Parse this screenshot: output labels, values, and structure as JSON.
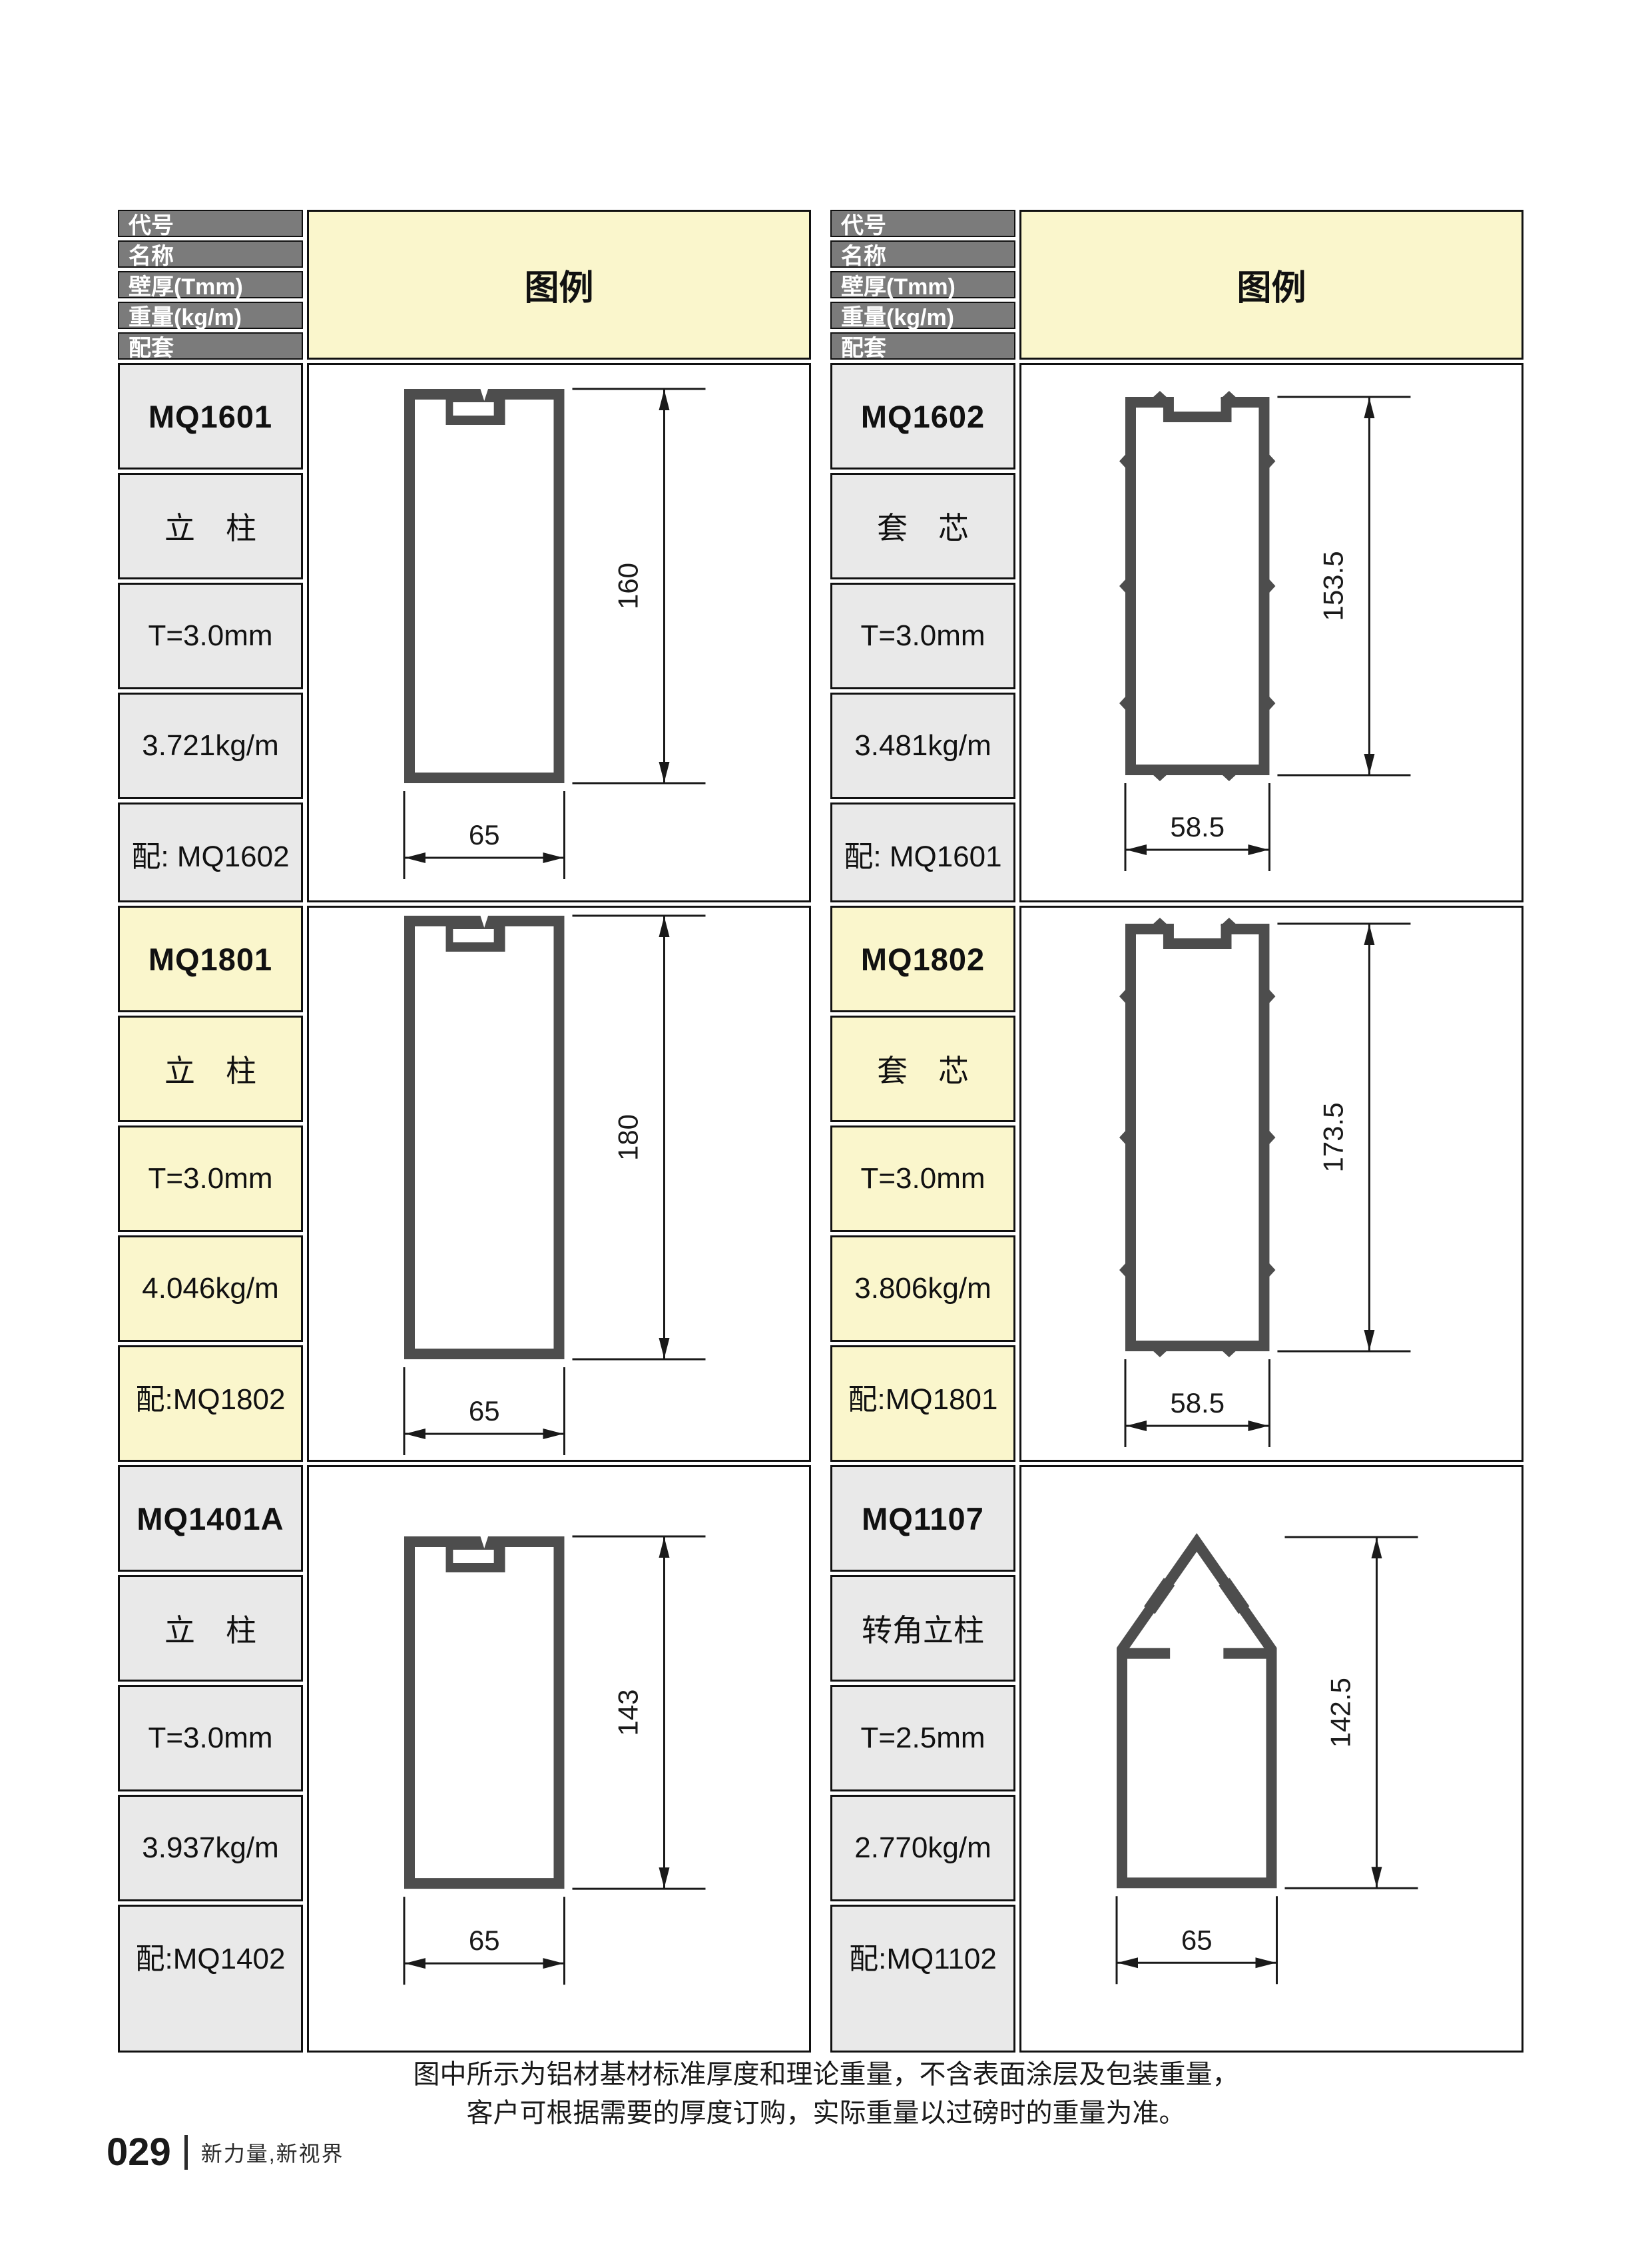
{
  "header_labels": [
    "代号",
    "名称",
    "壁厚(Tmm)",
    "重量(kg/m)",
    "配套"
  ],
  "legend_title": "图例",
  "note": {
    "line1": "图中所示为铝材基材标准厚度和理论重量，不含表面涂层及包装重量，",
    "line2": "客户可根据需要的厚度订购，实际重量以过磅时的重量为准。"
  },
  "footer": {
    "page_number": "029",
    "tagline": "新力量,新视界"
  },
  "colors": {
    "header_cell": "#7b7b7b",
    "cell_light": "#e9e9e9",
    "highlight": "#faf6cc",
    "border": "#111111",
    "profile_stroke": "#4d4d4d",
    "dimension": "#1a1a1a"
  },
  "tables": [
    {
      "side": "left",
      "profiles": [
        {
          "code": "MQ1601",
          "name": "立　柱",
          "thickness": "T=3.0mm",
          "weight": "3.721kg/m",
          "match": "配: MQ1602",
          "highlight": false,
          "drawing": {
            "type": "column",
            "height_mm": 160,
            "width_mm": 65,
            "height_label": "160",
            "width_label": "65"
          }
        },
        {
          "code": "MQ1801",
          "name": "立　柱",
          "thickness": "T=3.0mm",
          "weight": "4.046kg/m",
          "match": "配:MQ1802",
          "highlight": true,
          "drawing": {
            "type": "column",
            "height_mm": 180,
            "width_mm": 65,
            "height_label": "180",
            "width_label": "65"
          }
        },
        {
          "code": "MQ1401A",
          "name": "立　柱",
          "thickness": "T=3.0mm",
          "weight": "3.937kg/m",
          "match": "配:MQ1402",
          "highlight": false,
          "drawing": {
            "type": "column",
            "height_mm": 143,
            "width_mm": 65,
            "height_label": "143",
            "width_label": "65"
          }
        }
      ]
    },
    {
      "side": "right",
      "profiles": [
        {
          "code": "MQ1602",
          "name": "套　芯",
          "thickness": "T=3.0mm",
          "weight": "3.481kg/m",
          "match": "配: MQ1601",
          "highlight": false,
          "drawing": {
            "type": "sleeve",
            "height_mm": 153.5,
            "width_mm": 58.5,
            "height_label": "153.5",
            "width_label": "58.5"
          }
        },
        {
          "code": "MQ1802",
          "name": "套　芯",
          "thickness": "T=3.0mm",
          "weight": "3.806kg/m",
          "match": "配:MQ1801",
          "highlight": true,
          "drawing": {
            "type": "sleeve",
            "height_mm": 173.5,
            "width_mm": 58.5,
            "height_label": "173.5",
            "width_label": "58.5"
          }
        },
        {
          "code": "MQ1107",
          "name": "转角立柱",
          "thickness": "T=2.5mm",
          "weight": "2.770kg/m",
          "match": "配:MQ1102",
          "highlight": false,
          "drawing": {
            "type": "corner",
            "height_mm": 142.5,
            "width_mm": 65,
            "height_label": "142.5",
            "width_label": "65"
          }
        }
      ]
    }
  ]
}
